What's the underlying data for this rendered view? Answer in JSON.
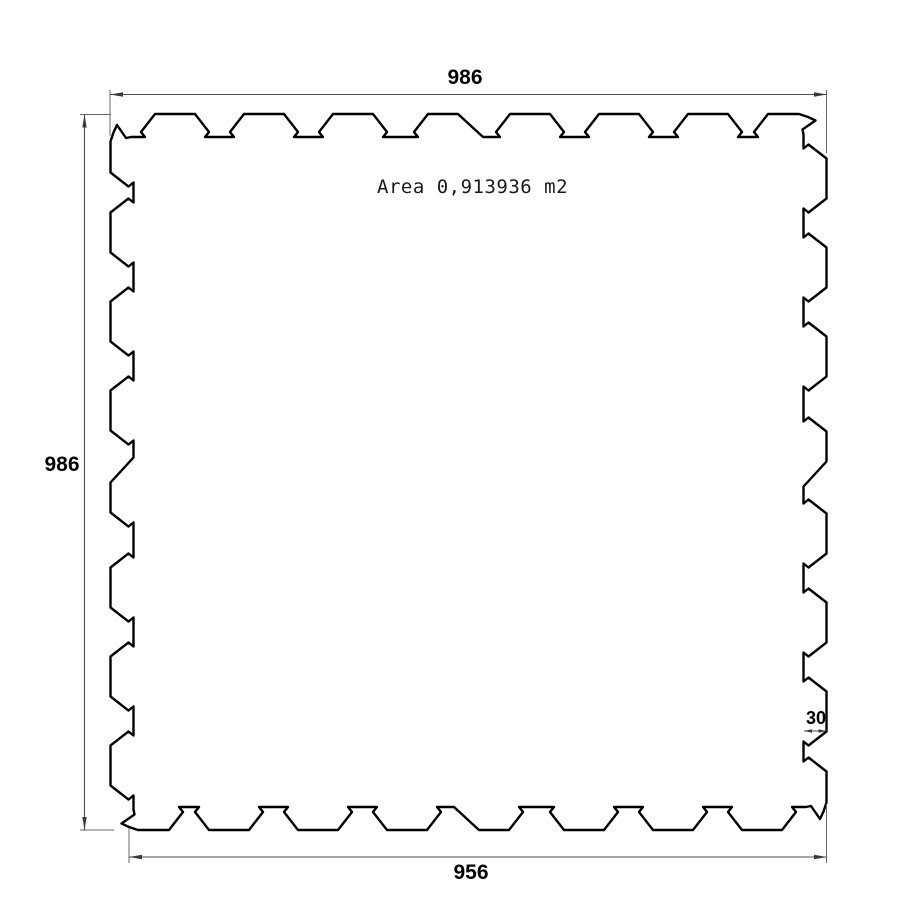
{
  "drawing": {
    "area_label": "Area 0,913936 m2",
    "dimensions": {
      "top_width": "986",
      "left_height": "986",
      "bottom_width": "956",
      "tooth_depth": "30"
    },
    "colors": {
      "outline": "#000000",
      "dimension_lines": "#4d4d4d",
      "background": "#ffffff"
    }
  }
}
